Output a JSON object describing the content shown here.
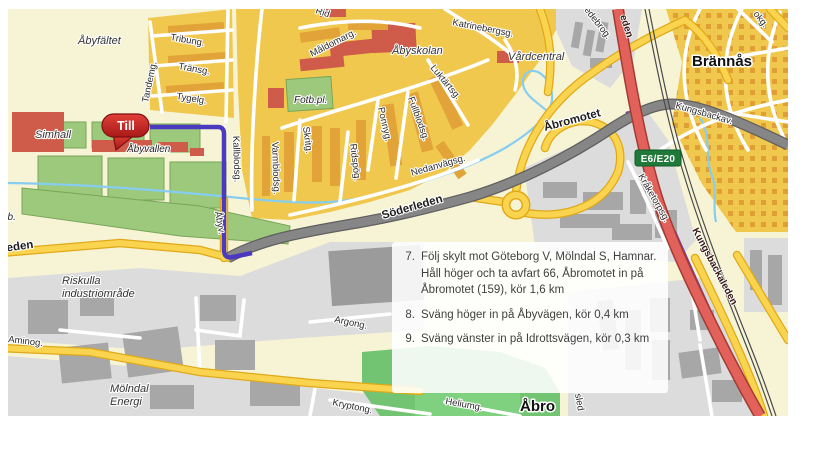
{
  "map": {
    "marker": {
      "label": "Till"
    },
    "road_badge": {
      "label": "E6/E20"
    },
    "colors": {
      "route": "#4b3ac0",
      "route_highway": "#7440b2",
      "highway_red": "#e2625b",
      "road_yellow": "#fbd44f",
      "road_gray": "#868686",
      "water": "#86cdf0",
      "marker_red": "#c5201f",
      "badge_green": "#1f7a3a",
      "area_orange": "#f1c84e",
      "area_green": "#9cc97c",
      "area_gray": "#dcdcdc",
      "building_red": "#cf5b4a"
    },
    "labels": [
      {
        "text": "Åbyfältet",
        "name": "abyfaltet",
        "x": 78,
        "y": 44,
        "rot": 0,
        "cls": "place"
      },
      {
        "text": "Simhall",
        "name": "simhall",
        "x": 35,
        "y": 138,
        "rot": 0,
        "cls": "place"
      },
      {
        "text": "Åbyvallen",
        "name": "abyvallen",
        "x": 127,
        "y": 152,
        "rot": 0,
        "cls": "place-sm"
      },
      {
        "text": "Fotb.pl.",
        "name": "fotb-pl",
        "x": 294,
        "y": 103,
        "rot": 0,
        "cls": "place-sm"
      },
      {
        "text": "Åbyskolan",
        "name": "abyskolan",
        "x": 392,
        "y": 54,
        "rot": 0,
        "cls": "place"
      },
      {
        "text": "Vårdcentral",
        "name": "vardcentral",
        "x": 508,
        "y": 60,
        "rot": 0,
        "cls": "place"
      },
      {
        "text": "Riskulla",
        "name": "riskulla",
        "x": 62,
        "y": 284,
        "rot": 0,
        "cls": "place"
      },
      {
        "text": "industriområde",
        "name": "industriomrade",
        "x": 62,
        "y": 297,
        "rot": 0,
        "cls": "place"
      },
      {
        "text": "Mölndal",
        "name": "molndal",
        "x": 110,
        "y": 392,
        "rot": 0,
        "cls": "place"
      },
      {
        "text": "Energi",
        "name": "energi",
        "x": 110,
        "y": 405,
        "rot": 0,
        "cls": "place"
      },
      {
        "text": "Brännås",
        "name": "brannas",
        "x": 692,
        "y": 66,
        "rot": 0,
        "cls": "district"
      },
      {
        "text": "Åbro",
        "name": "abro",
        "x": 520,
        "y": 411,
        "rot": 0,
        "cls": "district"
      },
      {
        "text": "Tribung.",
        "name": "tribung",
        "x": 170,
        "y": 40,
        "rot": 10,
        "cls": "street"
      },
      {
        "text": "Tandemg.",
        "name": "tandemg",
        "x": 148,
        "y": 103,
        "rot": -78,
        "cls": "street"
      },
      {
        "text": "Tränsg.",
        "name": "transg",
        "x": 178,
        "y": 69,
        "rot": 10,
        "cls": "street"
      },
      {
        "text": "Tygelg.",
        "name": "tygelg",
        "x": 176,
        "y": 99,
        "rot": 9,
        "cls": "street"
      },
      {
        "text": "Rid",
        "name": "rid-clipped",
        "x": 315,
        "y": 13,
        "rot": 18,
        "cls": "street"
      },
      {
        "text": "Måldomarg.",
        "name": "maldomarg",
        "x": 312,
        "y": 57,
        "rot": -27,
        "cls": "street"
      },
      {
        "text": "Katrinebergsg.",
        "name": "katrinebergsg",
        "x": 452,
        "y": 25,
        "rot": 11,
        "cls": "street"
      },
      {
        "text": "Luktärtsg.",
        "name": "luktartsg",
        "x": 430,
        "y": 68,
        "rot": 50,
        "cls": "street"
      },
      {
        "text": "Fullblodsg.",
        "name": "fullblodsg",
        "x": 408,
        "y": 98,
        "rot": 70,
        "cls": "street"
      },
      {
        "text": "Ponnyg.",
        "name": "ponnyg",
        "x": 378,
        "y": 108,
        "rot": 77,
        "cls": "street"
      },
      {
        "text": "Ridspög.",
        "name": "ridspog",
        "x": 350,
        "y": 144,
        "rot": 83,
        "cls": "street"
      },
      {
        "text": "Skritg.",
        "name": "skritg",
        "x": 303,
        "y": 127,
        "rot": 83,
        "cls": "street"
      },
      {
        "text": "Varmblodsg.",
        "name": "varmblodsg",
        "x": 272,
        "y": 142,
        "rot": 88,
        "cls": "street"
      },
      {
        "text": "Kallblodsg.",
        "name": "kallblodsg",
        "x": 233,
        "y": 136,
        "rot": 88,
        "cls": "street"
      },
      {
        "text": "Nedanvägsg.",
        "name": "nedanvagsg",
        "x": 412,
        "y": 176,
        "rot": -16,
        "cls": "street"
      },
      {
        "text": "Åbyv.",
        "name": "abyv",
        "x": 215,
        "y": 212,
        "rot": 80,
        "cls": "street"
      },
      {
        "text": "Söderleden",
        "name": "soderleden",
        "x": 383,
        "y": 219,
        "rot": -16,
        "cls": "road"
      },
      {
        "text": "Åbromotet",
        "name": "abromotet",
        "x": 545,
        "y": 131,
        "rot": -15,
        "cls": "road"
      },
      {
        "text": "Kungsbackav.",
        "name": "kungsbackav",
        "x": 675,
        "y": 108,
        "rot": 16,
        "cls": "street"
      },
      {
        "text": "Kråketorpsg.",
        "name": "kraketorpsg",
        "x": 638,
        "y": 176,
        "rot": 60,
        "cls": "street"
      },
      {
        "text": "Kungsbackaleden",
        "name": "kungsbackaleden",
        "x": 692,
        "y": 230,
        "rot": 62,
        "cls": "road-red"
      },
      {
        "text": "eden",
        "name": "eden-clipped",
        "x": 620,
        "y": 16,
        "rot": 72,
        "cls": "road-red"
      },
      {
        "text": "edebrog.",
        "name": "edebrog-clipped",
        "x": 584,
        "y": 10,
        "rot": 52,
        "cls": "street"
      },
      {
        "text": "okg.",
        "name": "okg-clipped",
        "x": 753,
        "y": 14,
        "rot": 52,
        "cls": "street"
      },
      {
        "text": "leden",
        "name": "leden-clipped",
        "x": 4,
        "y": 252,
        "rot": -8,
        "cls": "road"
      },
      {
        "text": "t.b.",
        "name": "tb-clipped",
        "x": 2,
        "y": 220,
        "rot": 0,
        "cls": "place-sm"
      },
      {
        "text": "Aminog.",
        "name": "aminog",
        "x": 8,
        "y": 342,
        "rot": 7,
        "cls": "street"
      },
      {
        "text": "Argong.",
        "name": "argong",
        "x": 334,
        "y": 322,
        "rot": 12,
        "cls": "street"
      },
      {
        "text": "Kryptong.",
        "name": "kryptong",
        "x": 332,
        "y": 405,
        "rot": 12,
        "cls": "street"
      },
      {
        "text": "Heliumg.",
        "name": "heliumg",
        "x": 445,
        "y": 404,
        "rot": 10,
        "cls": "street"
      },
      {
        "text": "sled",
        "name": "sled-clipped",
        "x": 575,
        "y": 394,
        "rot": 80,
        "cls": "street"
      },
      {
        "text": "den",
        "name": "frag-den",
        "x": 396,
        "y": 274,
        "rot": 0,
        "cls": "frag"
      },
      {
        "text": "ården",
        "name": "frag-arden",
        "x": 393,
        "y": 360,
        "rot": 0,
        "cls": "frag"
      }
    ]
  },
  "directions": {
    "steps": [
      {
        "number": "7.",
        "text": "Följ skylt mot Göteborg V, Mölndal S, Hamnar. Håll höger och ta avfart 66, Åbromotet in på Åbromotet (159), kör 1,6 km"
      },
      {
        "number": "8.",
        "text": "Sväng höger in på Åbyvägen, kör 0,4 km"
      },
      {
        "number": "9.",
        "text": "Sväng vänster in på Idrottsvägen, kör 0,3 km"
      }
    ]
  }
}
